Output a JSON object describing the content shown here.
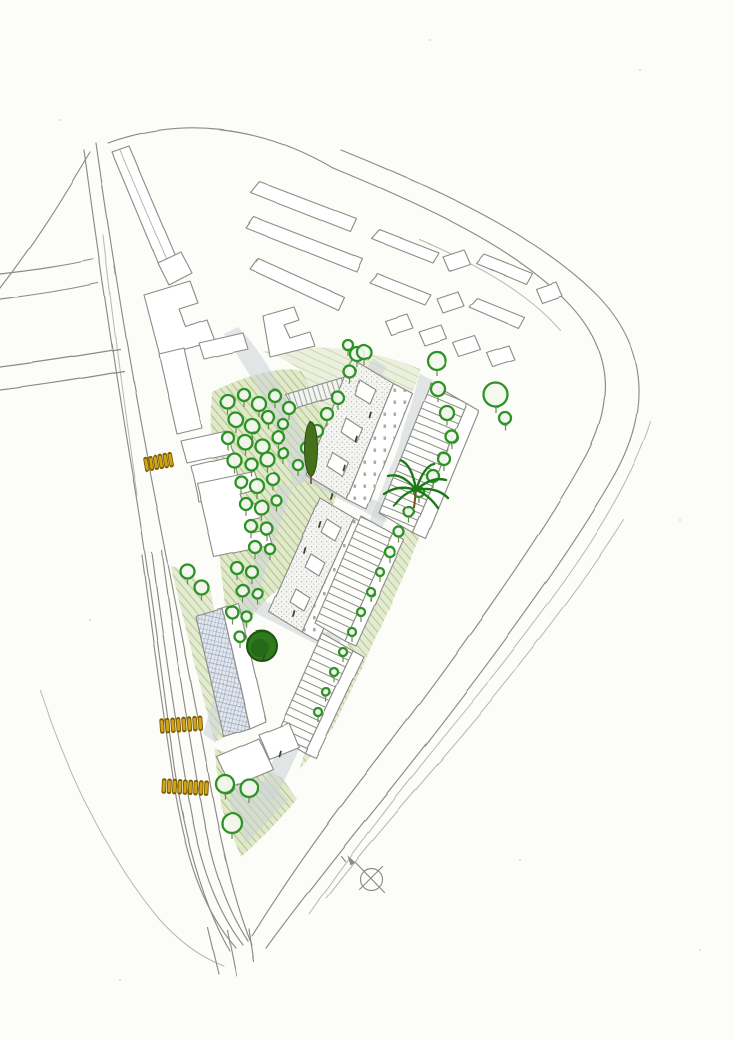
{
  "canvas": {
    "width": 735,
    "height": 1040
  },
  "palette": {
    "paper": "#fcfcf9",
    "pencil": "#8b8b87",
    "pencil-light": "#b6b6b2",
    "tree-green": "#2f9327",
    "ring-fill": "#f3f8ee",
    "tree-trunk": "#6b8a50",
    "tree-dark-fill": "#2e7a1f",
    "tree-dark-rim": "#1c5511",
    "cypress": "#44701c",
    "palm-green": "#1f7a16",
    "trunk-brown": "#7a4a28",
    "foliage-wash": "#dde7c5",
    "foliage-hatch": "#9fb271",
    "meadow-wash": "#e9eed8",
    "road-wash": "#ccd4d7",
    "yellow": "#d2a513",
    "yellow-dark": "#7a5c00",
    "figure": "#3f3f3d"
  },
  "compass": {
    "icon": "north-arrow-icon"
  },
  "trees": {
    "rings": [
      [
        228,
        402,
        7
      ],
      [
        244,
        395,
        6
      ],
      [
        259,
        404,
        7
      ],
      [
        275,
        396,
        6
      ],
      [
        289,
        408,
        6
      ],
      [
        236,
        420,
        7
      ],
      [
        252,
        426,
        7
      ],
      [
        268,
        417,
        6
      ],
      [
        283,
        424,
        5
      ],
      [
        228,
        438,
        6
      ],
      [
        245,
        442,
        7
      ],
      [
        262,
        446,
        7
      ],
      [
        278,
        437,
        6
      ],
      [
        234,
        460,
        7
      ],
      [
        251,
        464,
        6
      ],
      [
        267,
        459,
        7
      ],
      [
        283,
        453,
        5
      ],
      [
        241,
        482,
        6
      ],
      [
        257,
        486,
        7
      ],
      [
        273,
        479,
        6
      ],
      [
        246,
        504,
        6
      ],
      [
        262,
        508,
        7
      ],
      [
        277,
        501,
        5
      ],
      [
        251,
        526,
        6
      ],
      [
        267,
        529,
        6
      ],
      [
        255,
        547,
        6
      ],
      [
        270,
        549,
        5
      ],
      [
        237,
        568,
        6
      ],
      [
        252,
        572,
        6
      ],
      [
        243,
        591,
        6
      ],
      [
        258,
        594,
        5
      ],
      [
        233,
        613,
        6
      ],
      [
        247,
        617,
        5
      ],
      [
        240,
        637,
        5
      ],
      [
        357,
        354,
        7
      ],
      [
        350,
        372,
        6
      ],
      [
        338,
        398,
        6
      ],
      [
        327,
        414,
        6
      ],
      [
        317,
        431,
        6
      ],
      [
        307,
        448,
        6
      ],
      [
        298,
        465,
        5
      ],
      [
        348,
        345,
        5
      ],
      [
        364,
        352,
        7
      ],
      [
        437,
        361,
        9
      ],
      [
        496,
        395,
        12
      ],
      [
        505,
        418,
        6
      ],
      [
        438,
        389,
        7
      ],
      [
        447,
        413,
        7
      ],
      [
        452,
        437,
        6
      ],
      [
        444,
        459,
        6
      ],
      [
        433,
        476,
        6
      ],
      [
        419,
        492,
        5
      ],
      [
        409,
        512,
        5
      ],
      [
        399,
        532,
        5
      ],
      [
        390,
        552,
        5
      ],
      [
        380,
        572,
        4
      ],
      [
        371,
        592,
        4
      ],
      [
        361,
        612,
        4
      ],
      [
        352,
        632,
        4
      ],
      [
        343,
        652,
        4
      ],
      [
        334,
        672,
        4
      ],
      [
        326,
        692,
        4
      ],
      [
        318,
        712,
        4
      ],
      [
        188,
        572,
        7
      ],
      [
        202,
        588,
        7
      ],
      [
        225,
        784,
        9
      ],
      [
        249,
        788,
        9
      ],
      [
        232,
        823,
        10
      ]
    ],
    "dark_round": [
      {
        "x": 262,
        "y": 646,
        "r": 15
      }
    ],
    "cypress": {
      "x": 311,
      "y": 449,
      "rx": 6.5,
      "ry": 27
    },
    "palm": {
      "x": 416,
      "y": 490
    }
  },
  "crossings": [
    {
      "x": 146,
      "y": 464,
      "angle": -10,
      "count": 6,
      "spacing": 5
    },
    {
      "x": 162,
      "y": 726,
      "angle": -4,
      "count": 8,
      "spacing": 5.5
    },
    {
      "x": 164,
      "y": 786,
      "angle": 3,
      "count": 9,
      "spacing": 5.3
    }
  ],
  "figures": [
    [
      355,
      441
    ],
    [
      343,
      470
    ],
    [
      369,
      417
    ],
    [
      304,
      553
    ],
    [
      319,
      527
    ],
    [
      263,
      660
    ],
    [
      293,
      616
    ],
    [
      331,
      499
    ],
    [
      279,
      756
    ]
  ]
}
